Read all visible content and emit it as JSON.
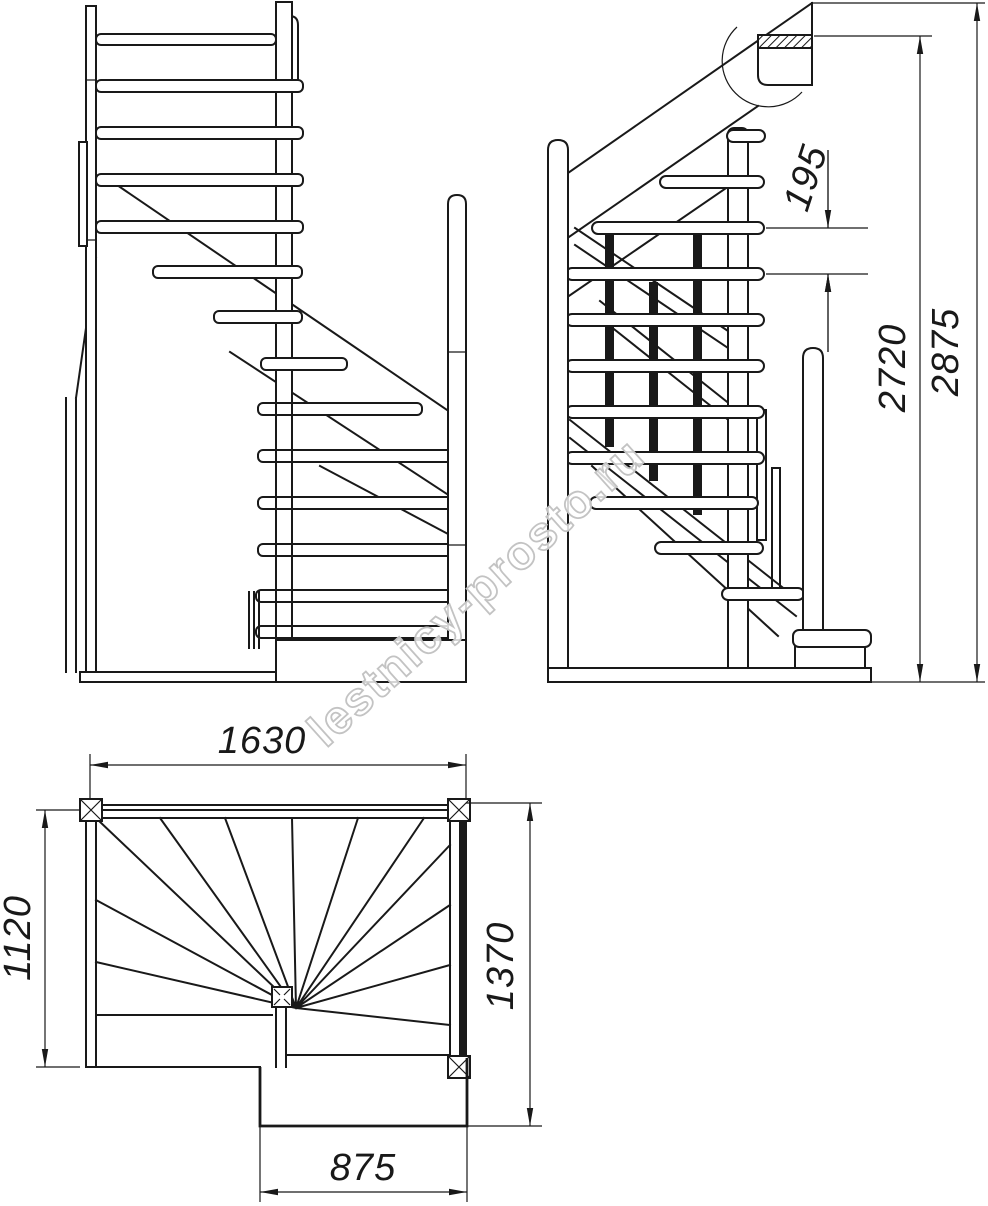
{
  "watermark": "lestnicy-prosto.ru",
  "dimensions": {
    "riser_height": "195",
    "height_to_floor": "2720",
    "total_height": "2875",
    "plan_width": "1630",
    "plan_depth_left": "1120",
    "plan_depth_right": "1370",
    "bottom_step_width": "875"
  },
  "colors": {
    "line": "#191919",
    "watermark_outline": "#c3c3c3",
    "background": "#ffffff"
  }
}
